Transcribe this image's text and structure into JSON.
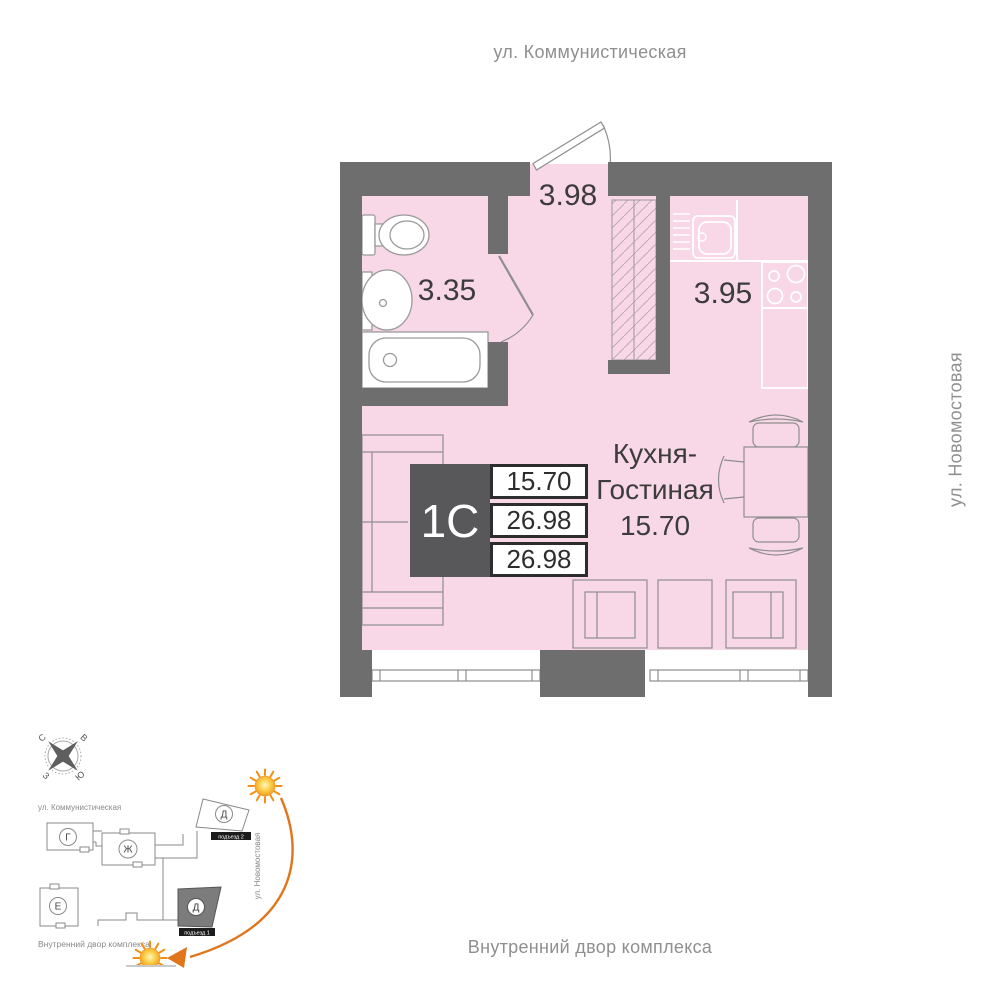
{
  "street_labels": {
    "top": "ул. Коммунистическая",
    "right": "ул. Новомостовая",
    "bottom": "Внутренний двор комплекса"
  },
  "apartment": {
    "type_code": "1С",
    "stats": [
      "15.70",
      "26.98",
      "26.98"
    ],
    "rooms": {
      "hallway_area": "3.98",
      "bathroom_area": "3.35",
      "kitchen_area": "3.95",
      "living": {
        "line1": "Кухня-",
        "line2": "Гостиная",
        "area": "15.70"
      }
    }
  },
  "site_plan": {
    "compass": {
      "north": "С",
      "east": "В",
      "west": "З",
      "south": "Ю"
    },
    "street_top": "ул. Коммунистическая",
    "street_right": "ул. Новомостовая",
    "courtyard_label": "Внутренний двор комплекса",
    "buildings": {
      "g": "Г",
      "zh": "Ж",
      "d2": "Д",
      "e": "Е",
      "d1": "Д"
    },
    "entrances": {
      "e1": "подъезд 1",
      "e2": "подъезд 2"
    }
  },
  "colors": {
    "wall": "#6e6e6e",
    "floor_pink": "#f8d7e6",
    "info_dark": "#58585b",
    "accent_orange": "#e0751c"
  }
}
